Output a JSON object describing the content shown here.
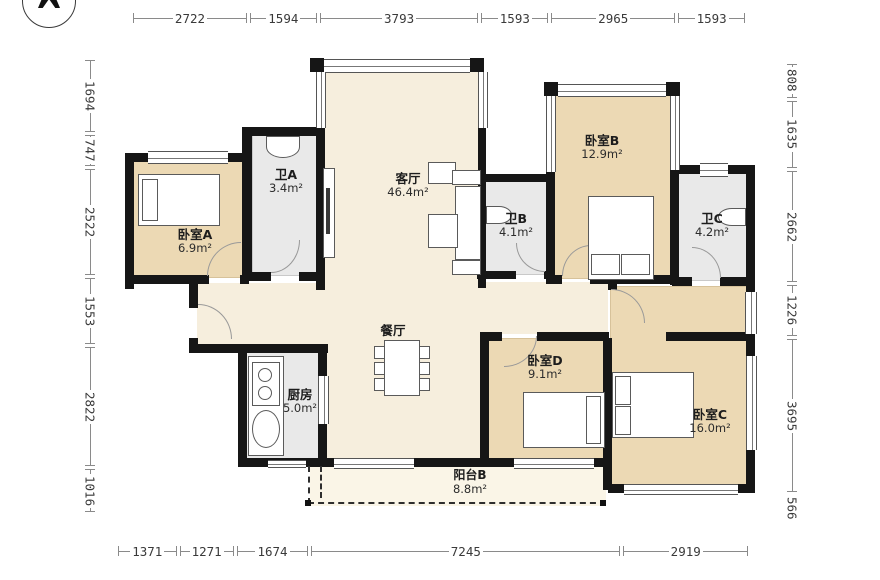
{
  "plan_title": "4室3卫户型图",
  "compass": {
    "direction": "north"
  },
  "rooms": {
    "bedroomA": {
      "name": "卧室A",
      "area": "6.9m²"
    },
    "bathA": {
      "name": "卫A",
      "area": "3.4m²"
    },
    "living": {
      "name": "客厅",
      "area": "46.4m²"
    },
    "bathB": {
      "name": "卫B",
      "area": "4.1m²"
    },
    "bedroomB": {
      "name": "卧室B",
      "area": "12.9m²"
    },
    "bathC": {
      "name": "卫C",
      "area": "4.2m²"
    },
    "dining": {
      "name": "餐厅",
      "area": ""
    },
    "kitchen": {
      "name": "厨房",
      "area": "5.0m²"
    },
    "bedroomD": {
      "name": "卧室D",
      "area": "9.1m²"
    },
    "bedroomC": {
      "name": "卧室C",
      "area": "16.0m²"
    },
    "balconyB": {
      "name": "阳台B",
      "area": "8.8m²"
    }
  },
  "dimensions": {
    "top": {
      "values": [
        2722,
        1594,
        3793,
        1593,
        2965,
        1593
      ]
    },
    "bottom": {
      "values": [
        1371,
        1271,
        1674,
        7245,
        2919
      ]
    },
    "left": {
      "values": [
        1694,
        747,
        2522,
        1553,
        2822,
        1016
      ]
    },
    "right": {
      "values": [
        808,
        1635,
        2662,
        1226,
        3695,
        566
      ]
    }
  },
  "colors": {
    "wall": "#161616",
    "bedroom_fill": "#ecd9b4",
    "bath_kitchen_fill": "#e9e9e9",
    "living_fill": "#f6eedd",
    "balcony_fill": "#faf5e7",
    "dimension_text": "#3a3a3a"
  }
}
